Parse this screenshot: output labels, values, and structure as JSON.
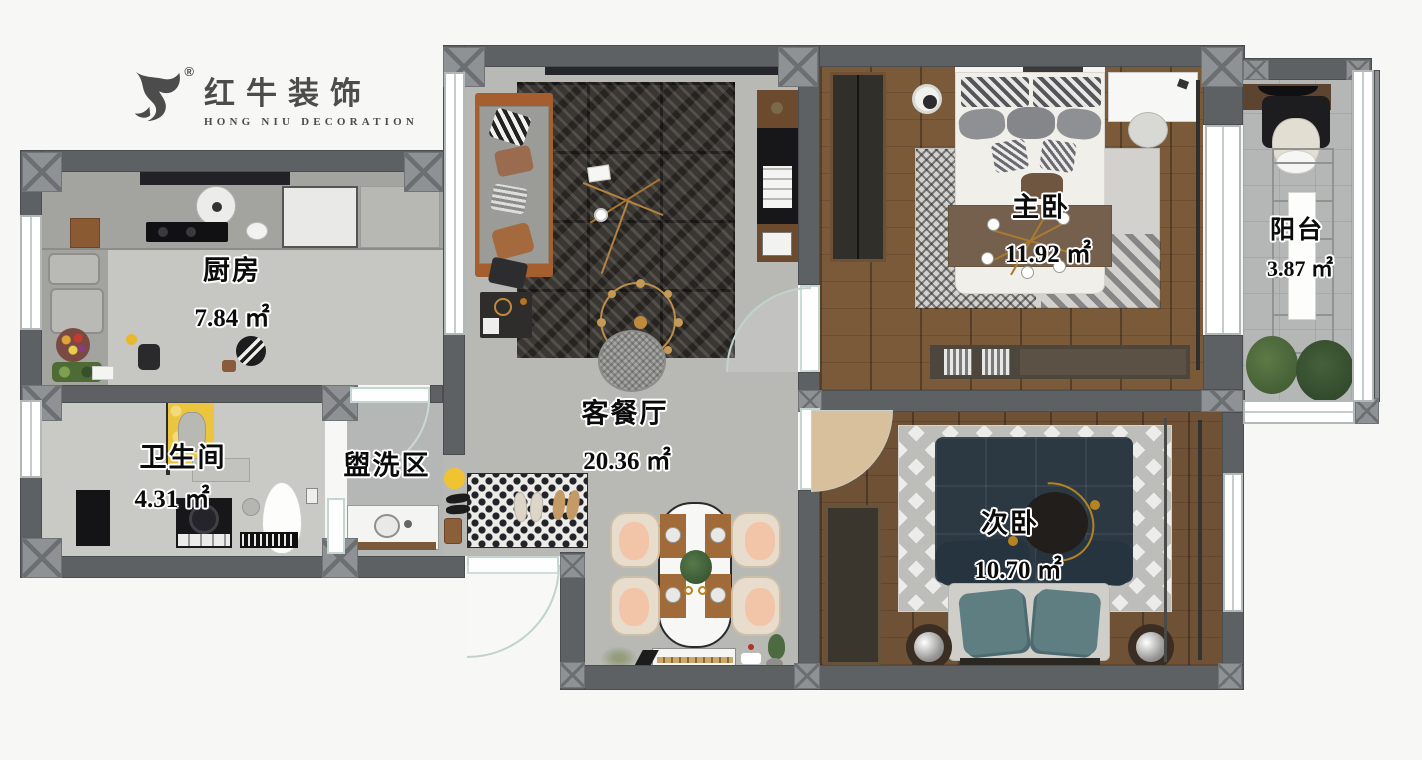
{
  "brand": {
    "logo_text": "红牛装饰",
    "logo_sub": "HONG NIU DECORATION",
    "registered": "®"
  },
  "rooms": {
    "kitchen": {
      "name": "厨房",
      "area": "7.84 ㎡"
    },
    "bathroom": {
      "name": "卫生间",
      "area": "4.31 ㎡"
    },
    "washing": {
      "name": "盥洗区",
      "area": ""
    },
    "living": {
      "name": "客餐厅",
      "area": "20.36 ㎡"
    },
    "master": {
      "name": "主卧",
      "area": "11.92 ㎡"
    },
    "second": {
      "name": "次卧",
      "area": "10.70 ㎡"
    },
    "balcony": {
      "name": "阳台",
      "area": "3.87 ㎡"
    }
  },
  "colors": {
    "wall": "#5e6163",
    "wood_floor": "#7b5a3a",
    "accent_gold": "#c08a3e",
    "navy_bed": "#2c3943",
    "teal_pillow": "#5f7e82",
    "yellow_mat": "#ecc53f"
  }
}
